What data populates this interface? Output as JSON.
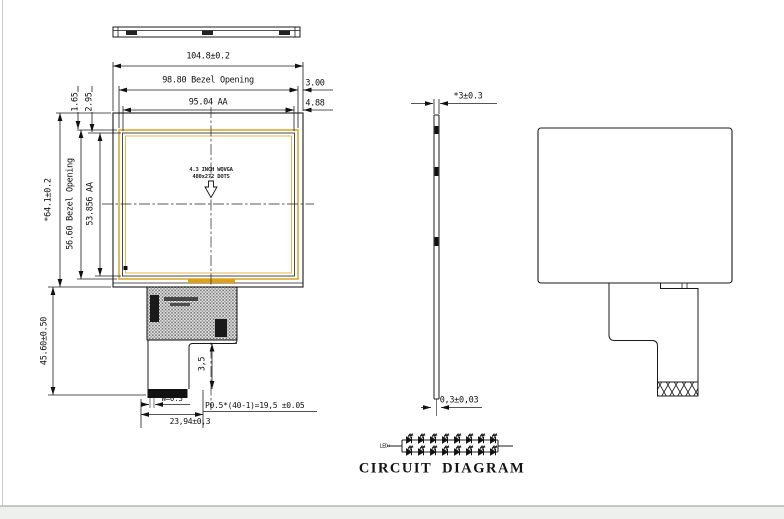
{
  "meta": {
    "background": "#ffffff",
    "line_color": "#1b1b1b",
    "accent_yellow": "#d9a427",
    "accent_orange": "#dfa016"
  },
  "front_view": {
    "dim_outline_width": "104.8±0.2",
    "dim_bezel_width": "98.80 Bezel Opening",
    "dim_aa_width": "95.04 AA",
    "dim_right_top": "3.00",
    "dim_right_bottom": "4.88",
    "dim_left_offset_1": "1.65",
    "dim_left_offset_2": "2.95",
    "dim_outline_height": "*64.1±0.2",
    "dim_bezel_height": "56.60 Bezel Opening",
    "dim_aa_height": "53.856 AA",
    "dim_tail_height": "45.60±0.50",
    "center_label_line1": "4.3 INCH WQVGA",
    "center_label_line2": "480x272 DOTS",
    "dim_fpc_step": "3,5",
    "dim_contact_width": "W=0.3",
    "dim_pin_pitch": "P0.5*(40-1)=19,5 ±0.05",
    "dim_connector_width": "23,94±0,3"
  },
  "side_view": {
    "dim_thickness": "*3±0.3",
    "dim_fpc_thickness": "0,3±0,03"
  },
  "circuit": {
    "lead_label": "LED+",
    "title": "CIRCUIT  DIAGRAM",
    "rows": 2,
    "leds_per_row": 8
  }
}
